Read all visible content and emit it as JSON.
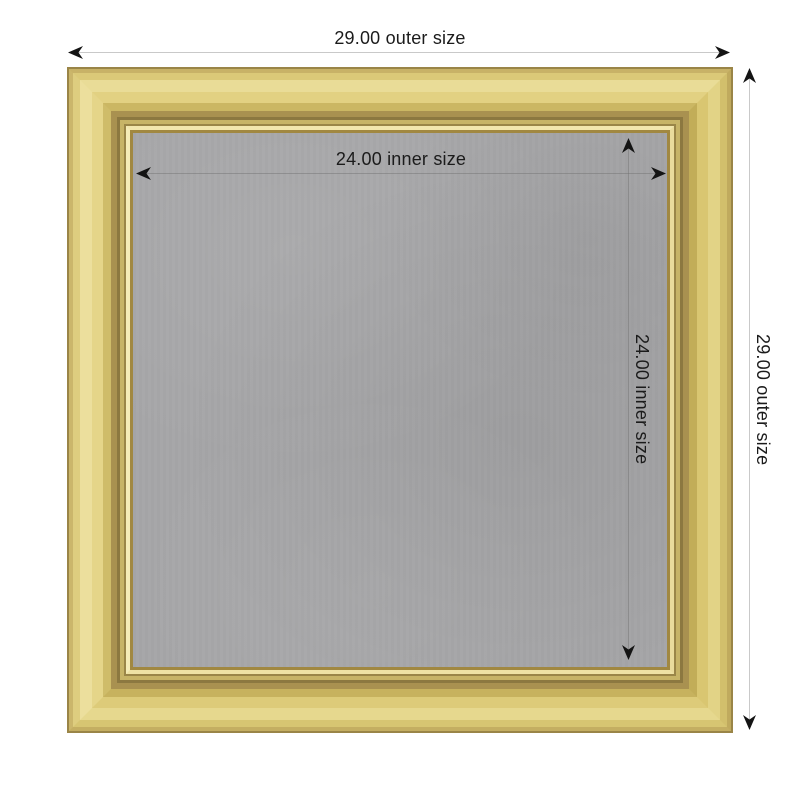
{
  "colors": {
    "background": "#ffffff",
    "text": "#1b1b1b",
    "arrow": "#141414",
    "outer_dimension_line": "#c9c9c9",
    "inner_dimension_line": "#6e6e6e",
    "frame_gold_highlight": "#e9dc97",
    "frame_gold_base": "#d7c574",
    "frame_gold_shadow": "#a99150",
    "frame_gold_lip": "#f2e7ae",
    "frame_gold_edge": "#9a8547",
    "board_gray": "#a6a6a8"
  },
  "dimensions": {
    "outer_size": "29.00",
    "inner_size": "24.00",
    "outer_width_label": "29.00 outer size",
    "outer_height_label": "29.00 outer size",
    "inner_width_label": "24.00 inner size",
    "inner_height_label": "24.00 inner size"
  }
}
